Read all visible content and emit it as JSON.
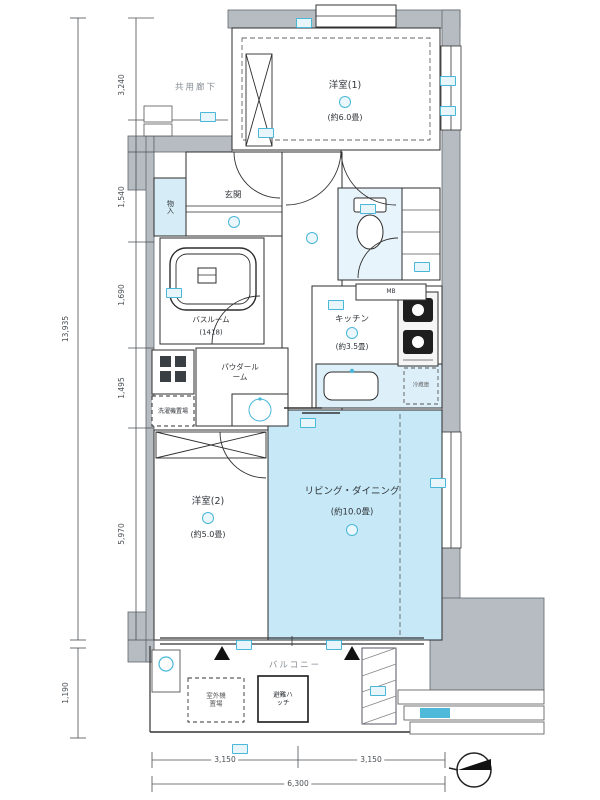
{
  "plan": {
    "corridor_label": "共用廊下",
    "balcony_label": "バルコニー",
    "entrance_label": "玄関",
    "rooms": {
      "bedroom1": {
        "name": "洋室(1)",
        "size": "(約6.0畳)"
      },
      "bedroom2": {
        "name": "洋室(2)",
        "size": "(約5.0畳)"
      },
      "living_dining": {
        "name": "リビング・ダイニング",
        "size": "(約10.0畳)"
      },
      "kitchen": {
        "name": "キッチン",
        "size": "(約3.5畳)"
      },
      "bathroom": {
        "name": "バスルーム",
        "size": "(1418)"
      },
      "powder_room": {
        "name": "パウダールーム"
      },
      "storage": {
        "name": "物入"
      },
      "laundry": {
        "name": "洗濯機置場"
      }
    },
    "fixtures": {
      "mb": "MB",
      "fridge": "冷蔵庫",
      "outdoor_unit": "室外機置場",
      "escape_hatch": "避難ハッチ"
    },
    "dimensions": {
      "bottom_left": "3,150",
      "bottom_right": "3,150",
      "bottom_total": "6,300",
      "left_seg_1": "3,240",
      "left_seg_2": "1,540",
      "left_seg_3": "1,690",
      "left_seg_4": "1,495",
      "left_seg_5": "5,970",
      "left_total": "13,935",
      "left_balcony": "1,190"
    },
    "colors": {
      "accent": "#49b7d8",
      "ld_fill": "#c6e8f7",
      "wall": "#b6bcc2"
    }
  }
}
